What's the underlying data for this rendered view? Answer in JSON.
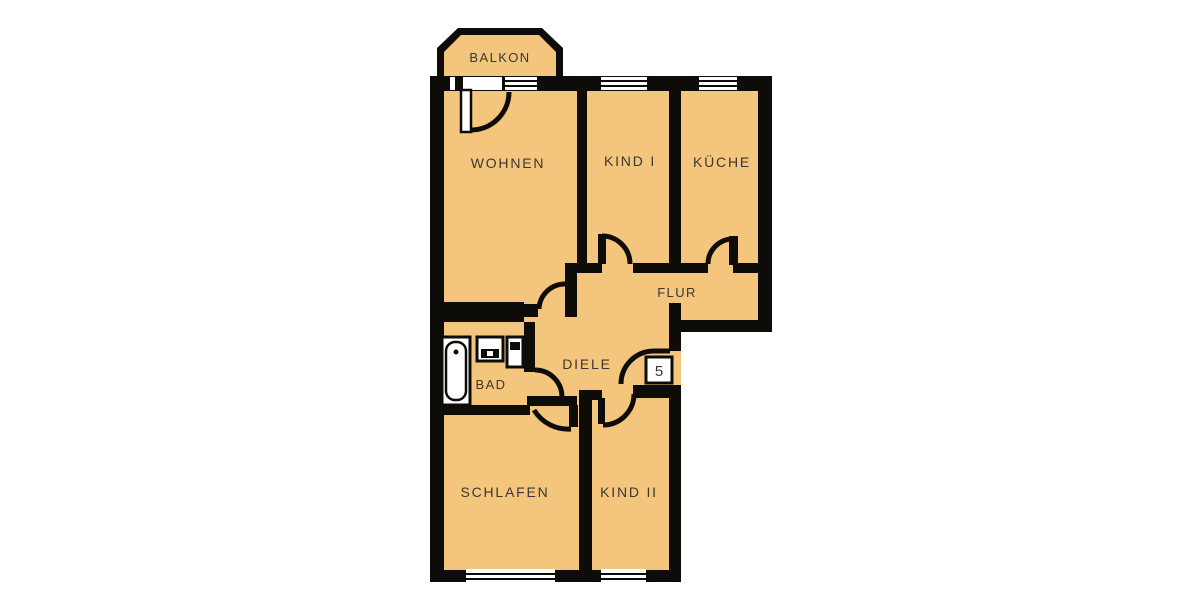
{
  "image_type": "apartment_floor_plan",
  "colors": {
    "background": "#ffffff",
    "floor_fill": "#f4c67d",
    "wall": "#0e0c09",
    "label_text": "#3b372f",
    "fixture_fill": "#ffffff"
  },
  "rooms": {
    "balkon": {
      "label": "BALKON"
    },
    "wohnen": {
      "label": "WOHNEN"
    },
    "kind1": {
      "label": "KIND I"
    },
    "kueche": {
      "label": "KÜCHE"
    },
    "flur": {
      "label": "FLUR"
    },
    "diele": {
      "label": "DIELE"
    },
    "bad": {
      "label": "BAD"
    },
    "schlafen": {
      "label": "SCHLAFEN"
    },
    "kind2": {
      "label": "KIND II"
    }
  },
  "entrance": {
    "unit_number": "5"
  },
  "fixtures": {
    "bathtub": "bathtub",
    "sink": "sink",
    "toilet": "toilet"
  }
}
